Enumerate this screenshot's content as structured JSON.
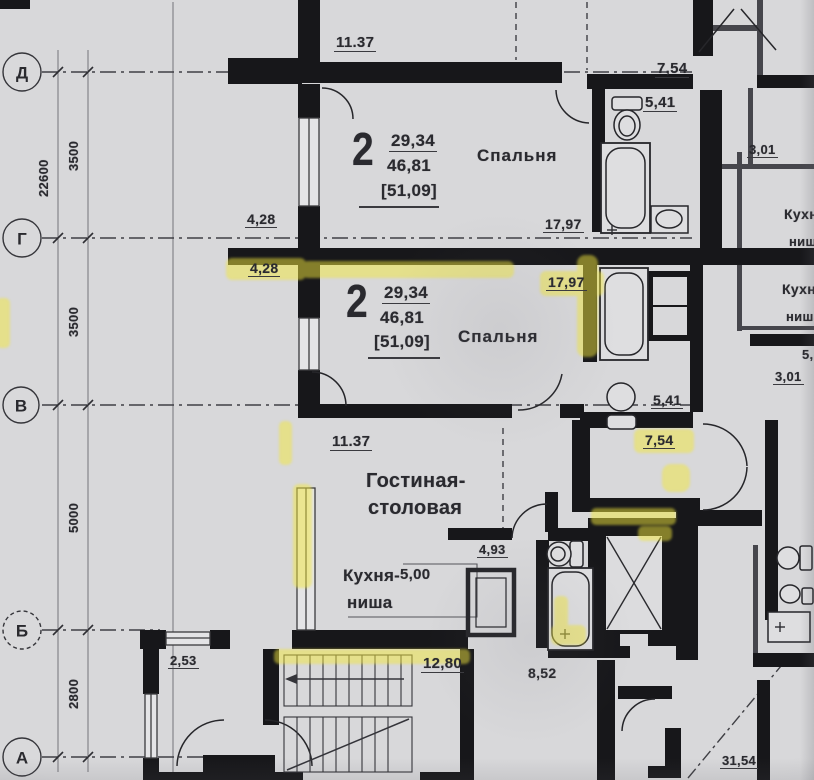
{
  "colors": {
    "paper": "#d8d8da",
    "ink": "#2a2a2f",
    "wall": "#17171a",
    "highlighter": "#f2e73c"
  },
  "grid": {
    "axis_circles": [
      {
        "label": "Д"
      },
      {
        "label": "Г"
      },
      {
        "label": "В"
      },
      {
        "label": "Б"
      },
      {
        "label": "А"
      }
    ],
    "overall_dim": "22600",
    "segment_dims": [
      "3500",
      "3500",
      "5000",
      "2800"
    ]
  },
  "apartment_top": {
    "rooms_count": "2",
    "living_area": "29,34",
    "total_area": "46,81",
    "overall_area": "[51,09]",
    "bedroom_label": "Спальня",
    "dim_top": "11.37",
    "dim_wall_left": "4,28",
    "dim_wall_right": "17,97",
    "dim_bath": "5,41",
    "dim_hall": "7,54"
  },
  "apartment_mid": {
    "rooms_count": "2",
    "living_area": "29,34",
    "total_area": "46,81",
    "overall_area": "[51,09]",
    "bedroom_label": "Спальня",
    "dim_wall_left": "4,28",
    "dim_wall_right": "17,97",
    "dim_bath": "5,41",
    "dim_hall": "7,54",
    "living_room_line1": "Гостиная-",
    "living_room_line2": "столовая",
    "dim_living": "11.37",
    "kitchen_niche_line1": "Кухня-",
    "kitchen_niche_line2": "ниша",
    "dim_kitchen": "5,00",
    "dim_entry_hall": "4,93"
  },
  "right_units": {
    "upper": {
      "kitchen_line1": "Кухня",
      "kitchen_line2": "ниша",
      "dim": "3,01"
    },
    "lower": {
      "kitchen_line1": "Кухня",
      "kitchen_line2": "ниша",
      "dim": "3,01",
      "dim_partial": "5,"
    }
  },
  "core": {
    "dim_vestibule": "2,53",
    "dim_stairs": "12,80",
    "dim_lift_lobby": "8,52",
    "dim_corridor": "31,54"
  }
}
